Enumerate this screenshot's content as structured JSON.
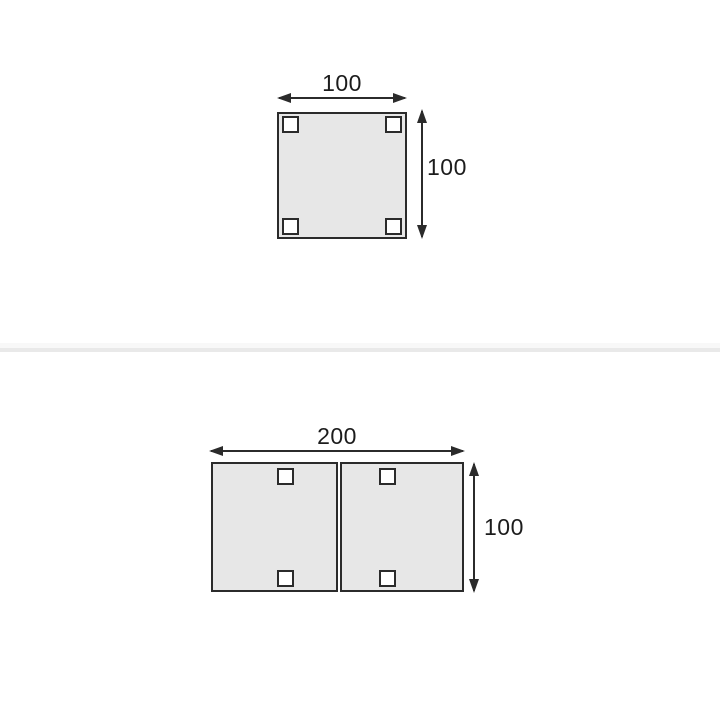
{
  "canvas": {
    "width": 720,
    "height": 720,
    "background": "#ffffff"
  },
  "colors": {
    "tabletop_fill": "#e7e7e7",
    "outline": "#2b2b2b",
    "label_text": "#1c1c1c",
    "leg_fill": "#ffffff",
    "section_divider": "#e9e9e9"
  },
  "figures": [
    {
      "id": "single-square-table-top-view",
      "width_label": "100",
      "height_label": "100",
      "leg_count": 4
    },
    {
      "id": "double-square-table-top-view",
      "width_label": "200",
      "height_label": "100",
      "leg_count": 4,
      "segments": 2
    }
  ]
}
